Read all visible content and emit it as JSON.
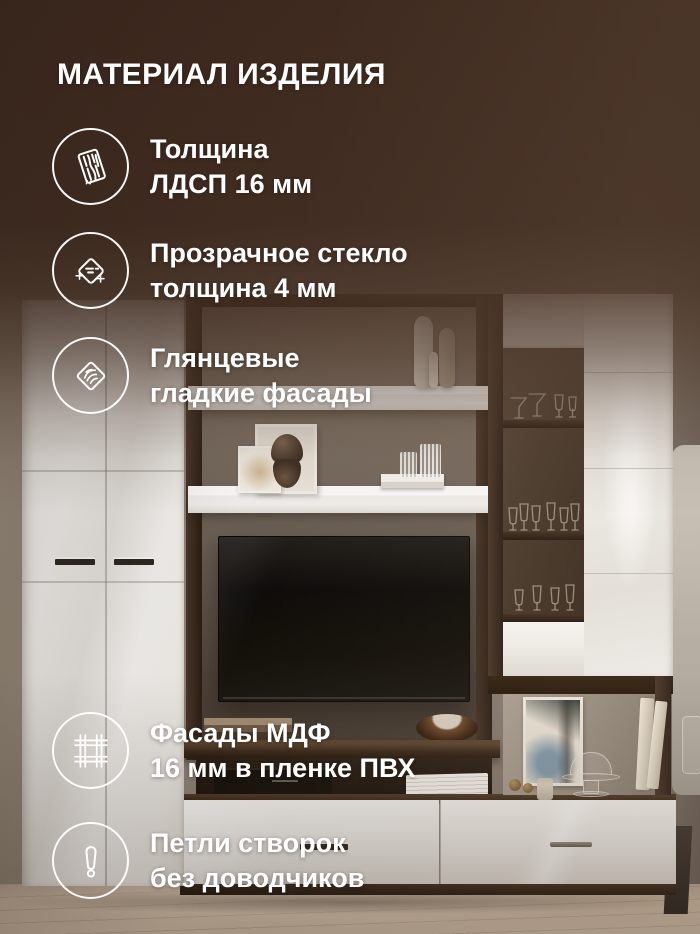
{
  "title": "МАТЕРИАЛ ИЗДЕЛИЯ",
  "features": [
    {
      "icon": "chipboard-icon",
      "lines": [
        "Толщина",
        "ЛДСП 16 мм"
      ]
    },
    {
      "icon": "glass-icon",
      "lines": [
        "Прозрачное стекло",
        "толщина 4 мм"
      ]
    },
    {
      "icon": "glossy-facade-icon",
      "lines": [
        "Глянцевые",
        "гладкие фасады"
      ]
    },
    {
      "icon": "mdf-pvc-icon",
      "lines": [
        "Фасады МДФ",
        "16 мм в пленке ПВХ"
      ]
    },
    {
      "icon": "hinge-warning-icon",
      "lines": [
        "Петли створок",
        "без доводчиков"
      ]
    }
  ],
  "palette": {
    "overlay_brown": "#422c20",
    "text_white": "#ffffff",
    "wenge_wood": "#35261c",
    "white_gloss": "#f2f0ed",
    "wall_taupe": "#8b8076",
    "floor_wood": "#c7b4a0"
  }
}
